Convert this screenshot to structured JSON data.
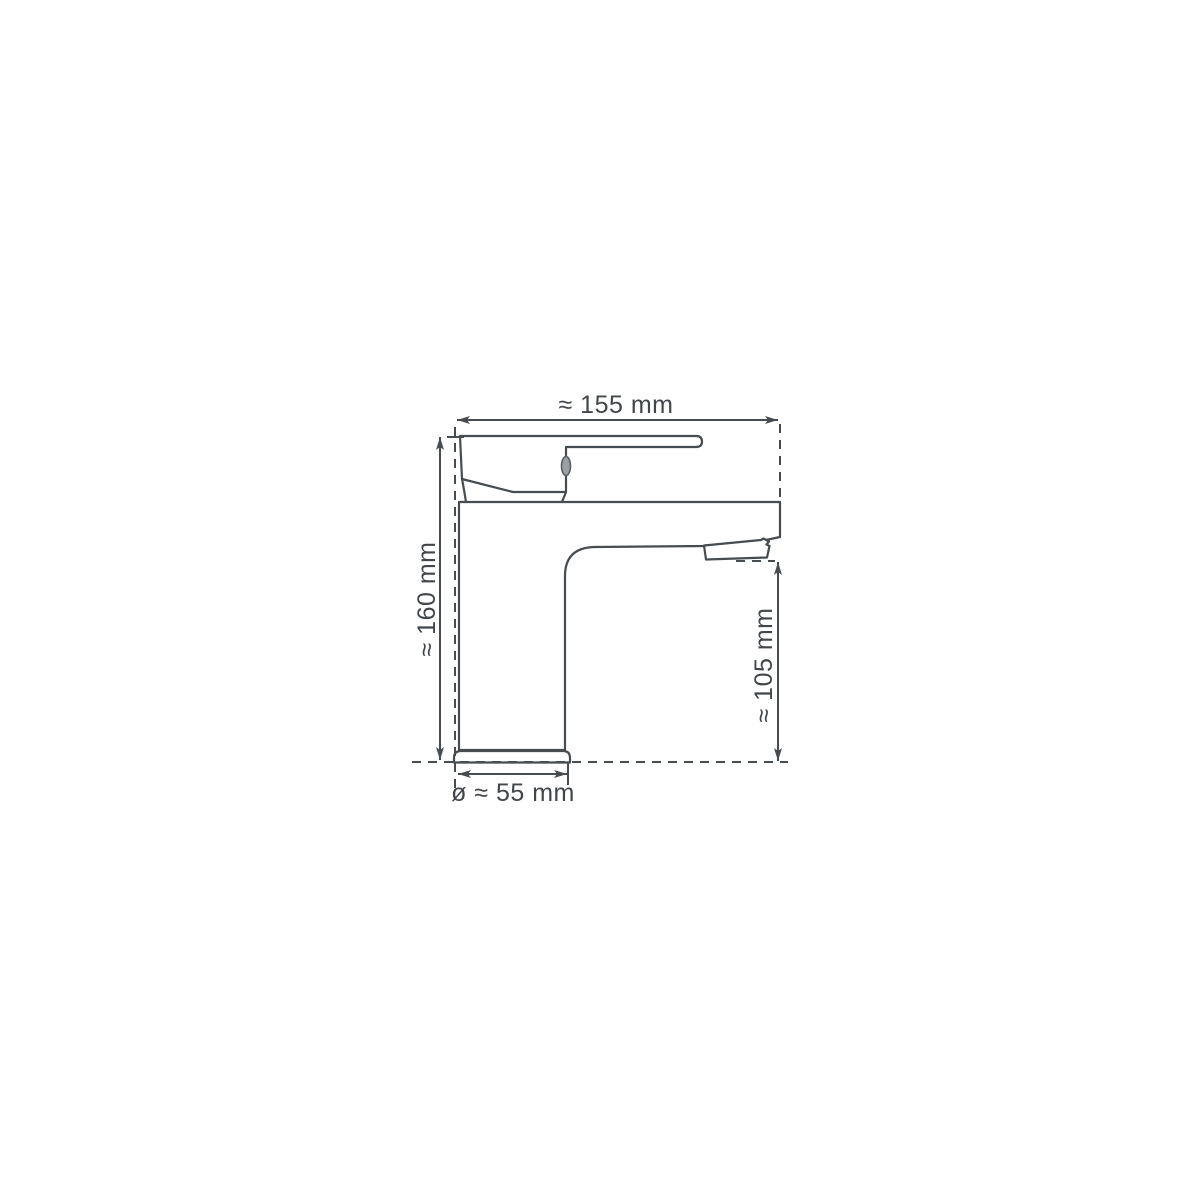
{
  "drawing": {
    "subject": "single-lever-basin-faucet-side-view-technical-drawing",
    "background": "#ffffff",
    "line_color": "#474c50",
    "text_color": "#41464b",
    "dimensions": {
      "top_width": "≈ 155 mm",
      "left_height": "≈ 160 mm",
      "right_spout_height": "≈ 105 mm",
      "base_diameter": "ø ≈ 55 mm"
    }
  }
}
